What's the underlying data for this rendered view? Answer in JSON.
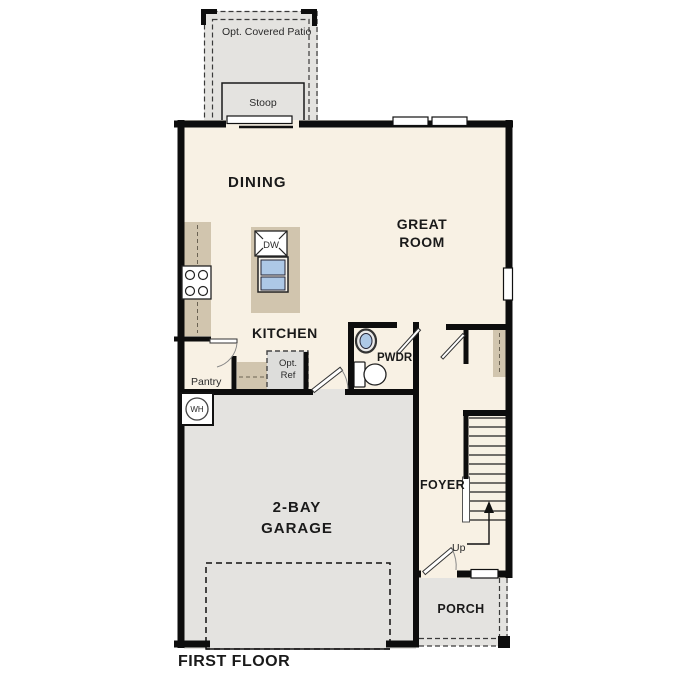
{
  "colors": {
    "wall": "#0d0d0d",
    "interior": "#f8f1e4",
    "concrete": "#e4e3e0",
    "counter": "#d1c5ae",
    "fixture_blue": "#adc8e6",
    "ref_fill": "#dddddb",
    "paper": "#ffffff",
    "ink": "#1a1a1a"
  },
  "labels": {
    "title": "FIRST FLOOR",
    "patio": "Opt. Covered Patio",
    "stoop": "Stoop",
    "dining": "DINING",
    "great_room_line1": "GREAT",
    "great_room_line2": "ROOM",
    "kitchen": "KITCHEN",
    "dishwasher": "DW",
    "pantry": "Pantry",
    "opt_ref_line1": "Opt.",
    "opt_ref_line2": "Ref",
    "powder": "PWDR",
    "water_heater": "WH",
    "garage_line1": "2-BAY",
    "garage_line2": "GARAGE",
    "foyer": "FOYER",
    "stairs_up": "Up",
    "porch": "PORCH"
  }
}
